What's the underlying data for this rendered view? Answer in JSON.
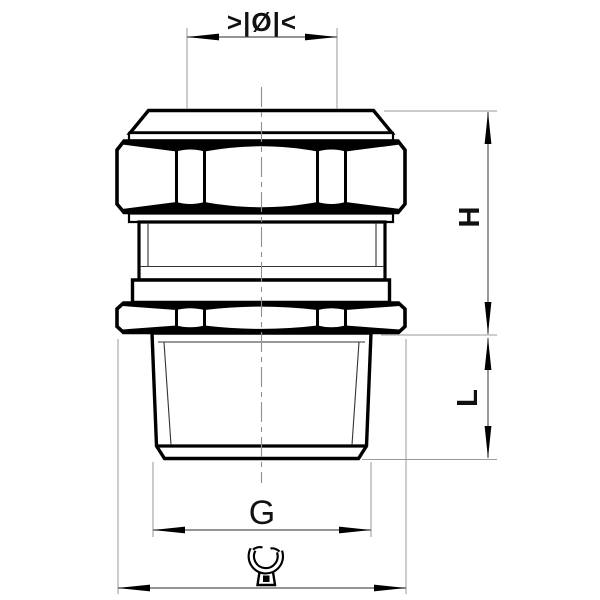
{
  "drawing": {
    "labels": {
      "clamping_range": ">|Ø|<",
      "height": "H",
      "thread_length": "L",
      "thread_size": "G"
    },
    "icons": {
      "wrench": "open-end-wrench-icon"
    },
    "colors": {
      "object_line": "#000000",
      "dimension_line": "#555555",
      "extension_line": "#999999",
      "background": "#ffffff"
    }
  }
}
